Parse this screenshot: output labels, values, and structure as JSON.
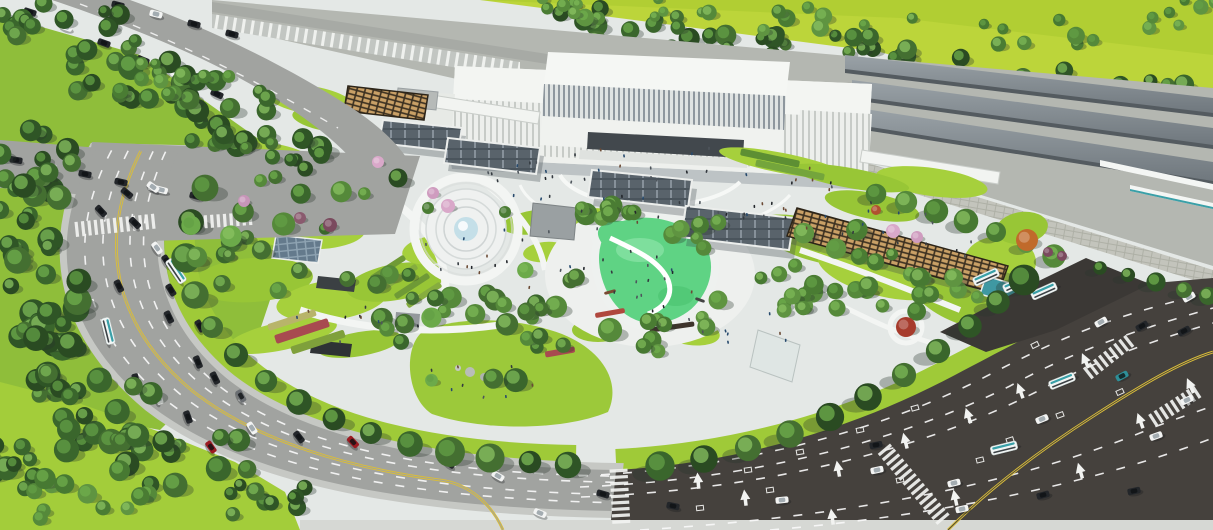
{
  "colors": {
    "plaza": "#e4e8e6",
    "plazaBright": "#f3f5f3",
    "grassTop": "#bcd53a",
    "grassTopDeep": "#aac92f",
    "grassSide": "#8fbe3a",
    "lawn1": "#a6d03c",
    "lawn2": "#98c636",
    "lawnBand": "#9fca38",
    "playground": "#5fd384",
    "playLight": "#7edf9d",
    "roadLight": "#a1a3a0",
    "roadDark": "#45413d",
    "roadDarker": "#3b3835",
    "corridor": "#b4b7b1",
    "canopy1": "#7d858b",
    "canopy2": "#99a1a6",
    "wall": "#c3c4bc",
    "yellow": "#d9bd3a",
    "white": "#ffffff",
    "mark": "#fafafa",
    "carDk": "#23262a",
    "carWh": "#f3f4f3",
    "carRd": "#9c1b22",
    "carGr": "#6a6e72",
    "carTl": "#2e8f98",
    "busBody": "#f2f6f5",
    "busTeal": "#3aa0a8",
    "trellis": "#3a2f20",
    "trellisSlat": "#c9a066",
    "glassRoof": "#59636b",
    "frame": "#eceeec",
    "shadow": "#2e3a34",
    "stationWhite": "#eef0ed",
    "fountainWater": "#c4dfe8",
    "hedge": "#4d7c2f",
    "treeShadow": "#27352c"
  },
  "palettes": {
    "dark": [
      "#2f5526",
      "#3a662c",
      "#446f31",
      "#2a4b22"
    ],
    "mid": [
      "#4a7c33",
      "#55893a",
      "#5f9441",
      "#477932"
    ],
    "bright": [
      "#5d9a3f",
      "#6caa4a",
      "#79b454"
    ],
    "mixed": [
      "#3a662c",
      "#55893a",
      "#6caa4a",
      "#446f31"
    ],
    "hl": [
      "#6fae4c",
      "#7cb857",
      "#8ac162",
      "#639f45"
    ]
  },
  "vehicles": [
    [
      118,
      5,
      14,
      "dk"
    ],
    [
      156,
      14,
      14,
      "wh"
    ],
    [
      194,
      24,
      15,
      "dk"
    ],
    [
      232,
      34,
      15,
      "dk"
    ],
    [
      30,
      12,
      18,
      "dk"
    ],
    [
      66,
      27,
      19,
      "wh"
    ],
    [
      104,
      43,
      20,
      "dk"
    ],
    [
      143,
      60,
      22,
      "dk"
    ],
    [
      181,
      77,
      23,
      "wh",
      20
    ],
    [
      217,
      94,
      25,
      "dk"
    ],
    [
      16,
      160,
      10,
      "dk"
    ],
    [
      50,
      167,
      11,
      "wh"
    ],
    [
      85,
      174,
      12,
      "dk"
    ],
    [
      121,
      182,
      13,
      "dk"
    ],
    [
      158,
      189,
      14,
      "wh",
      20
    ],
    [
      196,
      196,
      15,
      "dk"
    ],
    [
      127,
      193,
      40,
      "dk"
    ],
    [
      153,
      187,
      36,
      "wh"
    ],
    [
      101,
      211,
      47,
      "dk"
    ],
    [
      135,
      223,
      45,
      "dk"
    ],
    [
      157,
      248,
      54,
      "wh"
    ],
    [
      167,
      261,
      57,
      "dk"
    ],
    [
      119,
      286,
      64,
      "dk"
    ],
    [
      171,
      290,
      58,
      "dk"
    ],
    [
      176,
      271,
      56,
      "bus"
    ],
    [
      108,
      331,
      76,
      "bus"
    ],
    [
      169,
      317,
      64,
      "dk"
    ],
    [
      200,
      326,
      60,
      "dk"
    ],
    [
      198,
      362,
      68,
      "dk"
    ],
    [
      136,
      380,
      76,
      "dk"
    ],
    [
      159,
      398,
      73,
      "wh"
    ],
    [
      188,
      417,
      70,
      "dk"
    ],
    [
      215,
      378,
      64,
      "dk"
    ],
    [
      241,
      396,
      60,
      "gr"
    ],
    [
      252,
      428,
      57,
      "wh"
    ],
    [
      211,
      447,
      55,
      "rd"
    ],
    [
      299,
      437,
      52,
      "dk"
    ],
    [
      353,
      442,
      47,
      "rd"
    ],
    [
      405,
      448,
      43,
      "gr"
    ],
    [
      449,
      463,
      36,
      "dk"
    ],
    [
      498,
      476,
      30,
      "wh"
    ],
    [
      540,
      513,
      22,
      "wh"
    ],
    [
      603,
      494,
      16,
      "dk"
    ],
    [
      673,
      506,
      12,
      "dk"
    ],
    [
      782,
      500,
      -6,
      "wh"
    ],
    [
      877,
      470,
      -12,
      "wh"
    ],
    [
      954,
      483,
      -14,
      "wh"
    ],
    [
      962,
      509,
      -12,
      "wh"
    ],
    [
      1043,
      495,
      -15,
      "dk"
    ],
    [
      1134,
      491,
      -12,
      "dk"
    ],
    [
      1156,
      436,
      -20,
      "wh"
    ],
    [
      1042,
      419,
      -22,
      "wh"
    ],
    [
      876,
      445,
      -11,
      "dk"
    ],
    [
      1122,
      376,
      -28,
      "tl"
    ],
    [
      1187,
      400,
      -25,
      "wh"
    ],
    [
      1101,
      322,
      -30,
      "wh"
    ],
    [
      1142,
      326,
      -30,
      "dk"
    ],
    [
      1184,
      331,
      -28,
      "dk"
    ],
    [
      1189,
      297,
      -30,
      "wh"
    ],
    [
      1004,
      448,
      -14,
      "bus"
    ],
    [
      1062,
      381,
      -22,
      "bus"
    ],
    [
      986,
      277,
      -24,
      "bus"
    ],
    [
      1016,
      284,
      -24,
      "bus"
    ],
    [
      1044,
      291,
      -24,
      "bus"
    ]
  ],
  "tree_clusters": [
    [
      140,
      75,
      70,
      35,
      18,
      "dark",
      7,
      13,
      1
    ],
    [
      220,
      115,
      60,
      35,
      16,
      "dark",
      7,
      12,
      2
    ],
    [
      285,
      150,
      45,
      25,
      10,
      "dark",
      6,
      11,
      3
    ],
    [
      40,
      160,
      45,
      35,
      12,
      "dark",
      7,
      13,
      4
    ],
    [
      35,
      225,
      40,
      50,
      14,
      "dark",
      7,
      13,
      5
    ],
    [
      45,
      295,
      40,
      55,
      14,
      "dark",
      7,
      14,
      6
    ],
    [
      60,
      360,
      50,
      45,
      14,
      "dark",
      7,
      14,
      7
    ],
    [
      110,
      415,
      60,
      40,
      14,
      "dark",
      7,
      13,
      8
    ],
    [
      185,
      455,
      70,
      35,
      14,
      "dark",
      7,
      13,
      9
    ],
    [
      255,
      490,
      55,
      30,
      10,
      "dark",
      6,
      12,
      10
    ],
    [
      30,
      470,
      50,
      40,
      10,
      "dark",
      7,
      13,
      11
    ],
    [
      80,
      495,
      70,
      30,
      12,
      "mid",
      6,
      11,
      12
    ],
    [
      25,
      18,
      35,
      22,
      8,
      "dark",
      6,
      11,
      13
    ],
    [
      95,
      35,
      50,
      24,
      8,
      "dark",
      6,
      11,
      14
    ],
    [
      610,
      32,
      85,
      26,
      15,
      "dark",
      6,
      11,
      15
    ],
    [
      712,
      46,
      85,
      28,
      15,
      "dark",
      6,
      11,
      16
    ],
    [
      816,
      58,
      85,
      28,
      15,
      "dark",
      6,
      11,
      17
    ],
    [
      920,
      72,
      85,
      28,
      15,
      "dark",
      6,
      11,
      18
    ],
    [
      1024,
      86,
      85,
      28,
      14,
      "dark",
      6,
      11,
      19
    ],
    [
      1126,
      100,
      75,
      28,
      13,
      "dark",
      6,
      11,
      20
    ],
    [
      1195,
      112,
      40,
      20,
      7,
      "dark",
      6,
      10,
      21
    ],
    [
      640,
      8,
      120,
      12,
      8,
      "mid",
      5,
      9,
      22
    ],
    [
      860,
      20,
      140,
      14,
      9,
      "mid",
      5,
      9,
      23
    ],
    [
      1080,
      35,
      100,
      16,
      8,
      "mid",
      5,
      9,
      24
    ],
    [
      1180,
      12,
      60,
      14,
      6,
      "mid",
      5,
      9,
      25
    ],
    [
      560,
      5,
      60,
      10,
      5,
      "mid",
      5,
      8,
      26
    ],
    [
      290,
      235,
      110,
      70,
      20,
      "mixed",
      6,
      12,
      27
    ],
    [
      400,
      300,
      60,
      40,
      10,
      "mixed",
      6,
      11,
      28
    ],
    [
      480,
      335,
      90,
      55,
      14,
      "mixed",
      6,
      12,
      29
    ],
    [
      545,
      295,
      50,
      30,
      8,
      "mixed",
      6,
      10,
      30
    ],
    [
      600,
      220,
      45,
      20,
      6,
      "mid",
      6,
      10,
      31
    ],
    [
      700,
      240,
      40,
      20,
      5,
      "mid",
      6,
      10,
      32
    ],
    [
      660,
      330,
      50,
      25,
      7,
      "mid",
      6,
      11,
      33
    ],
    [
      850,
      265,
      95,
      45,
      16,
      "mid",
      6,
      11,
      34
    ],
    [
      940,
      300,
      60,
      25,
      8,
      "mid",
      6,
      10,
      35
    ],
    [
      805,
      300,
      40,
      25,
      8,
      "mid",
      6,
      10,
      36
    ],
    [
      160,
      80,
      70,
      26,
      10,
      "mid",
      5,
      9,
      37
    ]
  ],
  "tree_rows": [
    {
      "pts": [
        [
          205,
          188
        ],
        [
          191,
          222
        ],
        [
          186,
          258
        ],
        [
          195,
          295
        ],
        [
          212,
          327
        ],
        [
          236,
          355
        ],
        [
          266,
          381
        ],
        [
          299,
          402
        ],
        [
          334,
          419
        ],
        [
          371,
          433
        ],
        [
          410,
          444
        ],
        [
          450,
          452
        ],
        [
          490,
          458
        ],
        [
          530,
          462
        ],
        [
          568,
          465
        ]
      ],
      "r": 12,
      "pal": "dark",
      "sdx": 9,
      "sdy": 6,
      "seed": 41
    },
    {
      "pts": [
        [
          660,
          466
        ],
        [
          704,
          459
        ],
        [
          748,
          448
        ],
        [
          790,
          434
        ],
        [
          830,
          417
        ],
        [
          868,
          397
        ],
        [
          904,
          375
        ],
        [
          938,
          351
        ],
        [
          970,
          326
        ],
        [
          998,
          302
        ],
        [
          1024,
          280
        ]
      ],
      "r": 13,
      "pal": "dark",
      "sdx": -12,
      "sdy": 8,
      "seed": 42
    },
    {
      "pts": [
        [
          876,
          194
        ],
        [
          906,
          202
        ],
        [
          936,
          211
        ],
        [
          966,
          221
        ],
        [
          996,
          232
        ],
        [
          1026,
          244
        ],
        [
          1054,
          256
        ]
      ],
      "r": 10,
      "pal": "mid",
      "sdx": -8,
      "sdy": 6,
      "seed": 43
    },
    {
      "pts": [
        [
          1100,
          268
        ],
        [
          1128,
          275
        ],
        [
          1156,
          282
        ],
        [
          1184,
          290
        ],
        [
          1208,
          296
        ]
      ],
      "r": 8,
      "pal": "dark",
      "sdx": -8,
      "sdy": 5,
      "seed": 44
    },
    {
      "pts": [
        [
          230,
          108
        ],
        [
          320,
          148
        ],
        [
          398,
          178
        ]
      ],
      "r": 10,
      "pal": "dark",
      "sdx": 7,
      "sdy": 5,
      "seed": 45
    },
    {
      "pts": [
        [
          586,
          214
        ],
        [
          612,
          206
        ],
        [
          700,
          225
        ],
        [
          718,
          300
        ],
        [
          652,
          340
        ],
        [
          610,
          330
        ]
      ],
      "r": 10,
      "pal": "mid",
      "sdx": 6,
      "sdy": 5,
      "seed": 46
    }
  ],
  "special_trees": [
    [
      448,
      206,
      7,
      "#d9a8c9"
    ],
    [
      433,
      193,
      6,
      "#cf9cbf"
    ],
    [
      893,
      231,
      7,
      "#d9a8c9"
    ],
    [
      917,
      237,
      6,
      "#cf9cbf"
    ],
    [
      244,
      201,
      6,
      "#c795b8"
    ],
    [
      378,
      162,
      6,
      "#d9a8c9"
    ],
    [
      906,
      327,
      10,
      "#a63b2c"
    ],
    [
      1027,
      240,
      11,
      "#c06a2b"
    ],
    [
      1048,
      252,
      5,
      "#7a4a5e"
    ],
    [
      1062,
      256,
      5,
      "#7a4a5e"
    ],
    [
      330,
      225,
      7,
      "#7a4a5e"
    ],
    [
      300,
      218,
      6,
      "#8a5a6e"
    ],
    [
      876,
      210,
      5,
      "#b0512f"
    ],
    [
      428,
      208,
      6,
      "#4a7c33"
    ],
    [
      505,
      212,
      6,
      "#4a7c33"
    ]
  ],
  "people_clusters": [
    [
      655,
      185,
      190,
      40,
      55,
      61
    ],
    [
      540,
      255,
      120,
      35,
      22,
      62
    ],
    [
      860,
      215,
      90,
      28,
      14,
      63
    ],
    [
      360,
      318,
      75,
      25,
      10,
      64
    ],
    [
      655,
      288,
      45,
      28,
      12,
      65
    ],
    [
      480,
      380,
      60,
      20,
      8,
      66
    ],
    [
      740,
      330,
      60,
      25,
      8,
      67
    ],
    [
      940,
      250,
      50,
      20,
      6,
      68
    ]
  ],
  "people_colors": [
    "#22262b",
    "#343a40",
    "#4e555c",
    "#6b4a35",
    "#274a6d"
  ],
  "lawns": [
    [
      262,
      158,
      52,
      16,
      6
    ],
    [
      222,
      208,
      40,
      20,
      0
    ],
    [
      300,
      225,
      66,
      24,
      4
    ],
    [
      253,
      280,
      60,
      22,
      -4
    ],
    [
      332,
      300,
      56,
      20,
      -8
    ],
    [
      396,
      282,
      50,
      18,
      -10
    ],
    [
      282,
      336,
      56,
      14,
      -12
    ],
    [
      360,
      344,
      42,
      12,
      -10
    ],
    [
      432,
      250,
      30,
      14,
      -8
    ],
    [
      536,
      222,
      34,
      12,
      -8
    ],
    [
      585,
      222,
      28,
      13,
      -12
    ],
    [
      720,
      260,
      22,
      12,
      18
    ],
    [
      690,
      332,
      30,
      13,
      8
    ],
    [
      598,
      330,
      26,
      12,
      0
    ],
    [
      545,
      252,
      22,
      10,
      -6
    ],
    [
      812,
      240,
      58,
      20,
      17
    ],
    [
      882,
      272,
      66,
      24,
      14
    ],
    [
      958,
      302,
      50,
      20,
      24
    ],
    [
      1000,
      262,
      36,
      26,
      0
    ],
    [
      872,
      206,
      48,
      13,
      11
    ],
    [
      932,
      182,
      56,
      14,
      8
    ],
    [
      1022,
      228,
      26,
      16,
      -8
    ],
    [
      782,
      163,
      64,
      10,
      11
    ],
    [
      850,
      178,
      60,
      10,
      10
    ],
    [
      310,
      100,
      45,
      14,
      9
    ],
    [
      332,
      120,
      40,
      12,
      8
    ]
  ],
  "crosswalks": [
    [
      118,
      225,
      -6,
      86,
      15
    ],
    [
      230,
      220,
      -4,
      52,
      13
    ],
    [
      620,
      498,
      87,
      58,
      18
    ],
    [
      916,
      487,
      50,
      100,
      16
    ],
    [
      1110,
      356,
      -38,
      58,
      14
    ],
    [
      1178,
      404,
      -33,
      62,
      14
    ]
  ],
  "arrows": [
    [
      698,
      480,
      -5
    ],
    [
      745,
      497,
      -7
    ],
    [
      838,
      468,
      -10
    ],
    [
      905,
      440,
      -14
    ],
    [
      968,
      415,
      -18
    ],
    [
      1020,
      390,
      -20
    ],
    [
      1085,
      360,
      -24
    ],
    [
      832,
      516,
      -8
    ],
    [
      955,
      497,
      -12
    ],
    [
      1080,
      470,
      -16
    ],
    [
      1140,
      420,
      -20
    ],
    [
      1190,
      385,
      -24
    ]
  ],
  "loops": [
    [
      748,
      470,
      -8
    ],
    [
      800,
      452,
      -10
    ],
    [
      860,
      430,
      -12
    ],
    [
      915,
      408,
      -16
    ],
    [
      700,
      508,
      -6
    ],
    [
      770,
      490,
      -8
    ],
    [
      900,
      480,
      -12
    ],
    [
      1010,
      440,
      -18
    ],
    [
      1060,
      415,
      -20
    ],
    [
      1120,
      392,
      -24
    ],
    [
      980,
      460,
      -14
    ],
    [
      1035,
      345,
      -26
    ]
  ],
  "flowerbeds": [
    [
      302,
      331,
      56,
      9,
      -18,
      "#a84a50"
    ],
    [
      318,
      342,
      56,
      8,
      -18,
      "#7fa03b"
    ],
    [
      292,
      320,
      50,
      7,
      -18,
      "#b8b46a"
    ],
    [
      388,
      268,
      40,
      6,
      -33,
      "#6f9a36"
    ],
    [
      400,
      277,
      40,
      6,
      -33,
      "#86ad3f"
    ],
    [
      412,
      286,
      40,
      6,
      -33,
      "#6f9a36"
    ],
    [
      424,
      295,
      40,
      6,
      -33,
      "#86ad3f"
    ],
    [
      560,
      352,
      30,
      6,
      -10,
      "#a84a50"
    ],
    [
      770,
      158,
      60,
      7,
      12,
      "#5d8f33"
    ],
    [
      790,
      170,
      70,
      7,
      12,
      "#74a53c"
    ],
    [
      672,
      327,
      45,
      5,
      -8,
      "#3e342c"
    ],
    [
      610,
      313,
      30,
      5,
      -10,
      "#b0483e"
    ],
    [
      610,
      292,
      12,
      3,
      -15,
      "#7a4a32"
    ],
    [
      652,
      318,
      12,
      3,
      5,
      "#7a4a32"
    ],
    [
      700,
      300,
      10,
      3,
      20,
      "#444444"
    ]
  ]
}
